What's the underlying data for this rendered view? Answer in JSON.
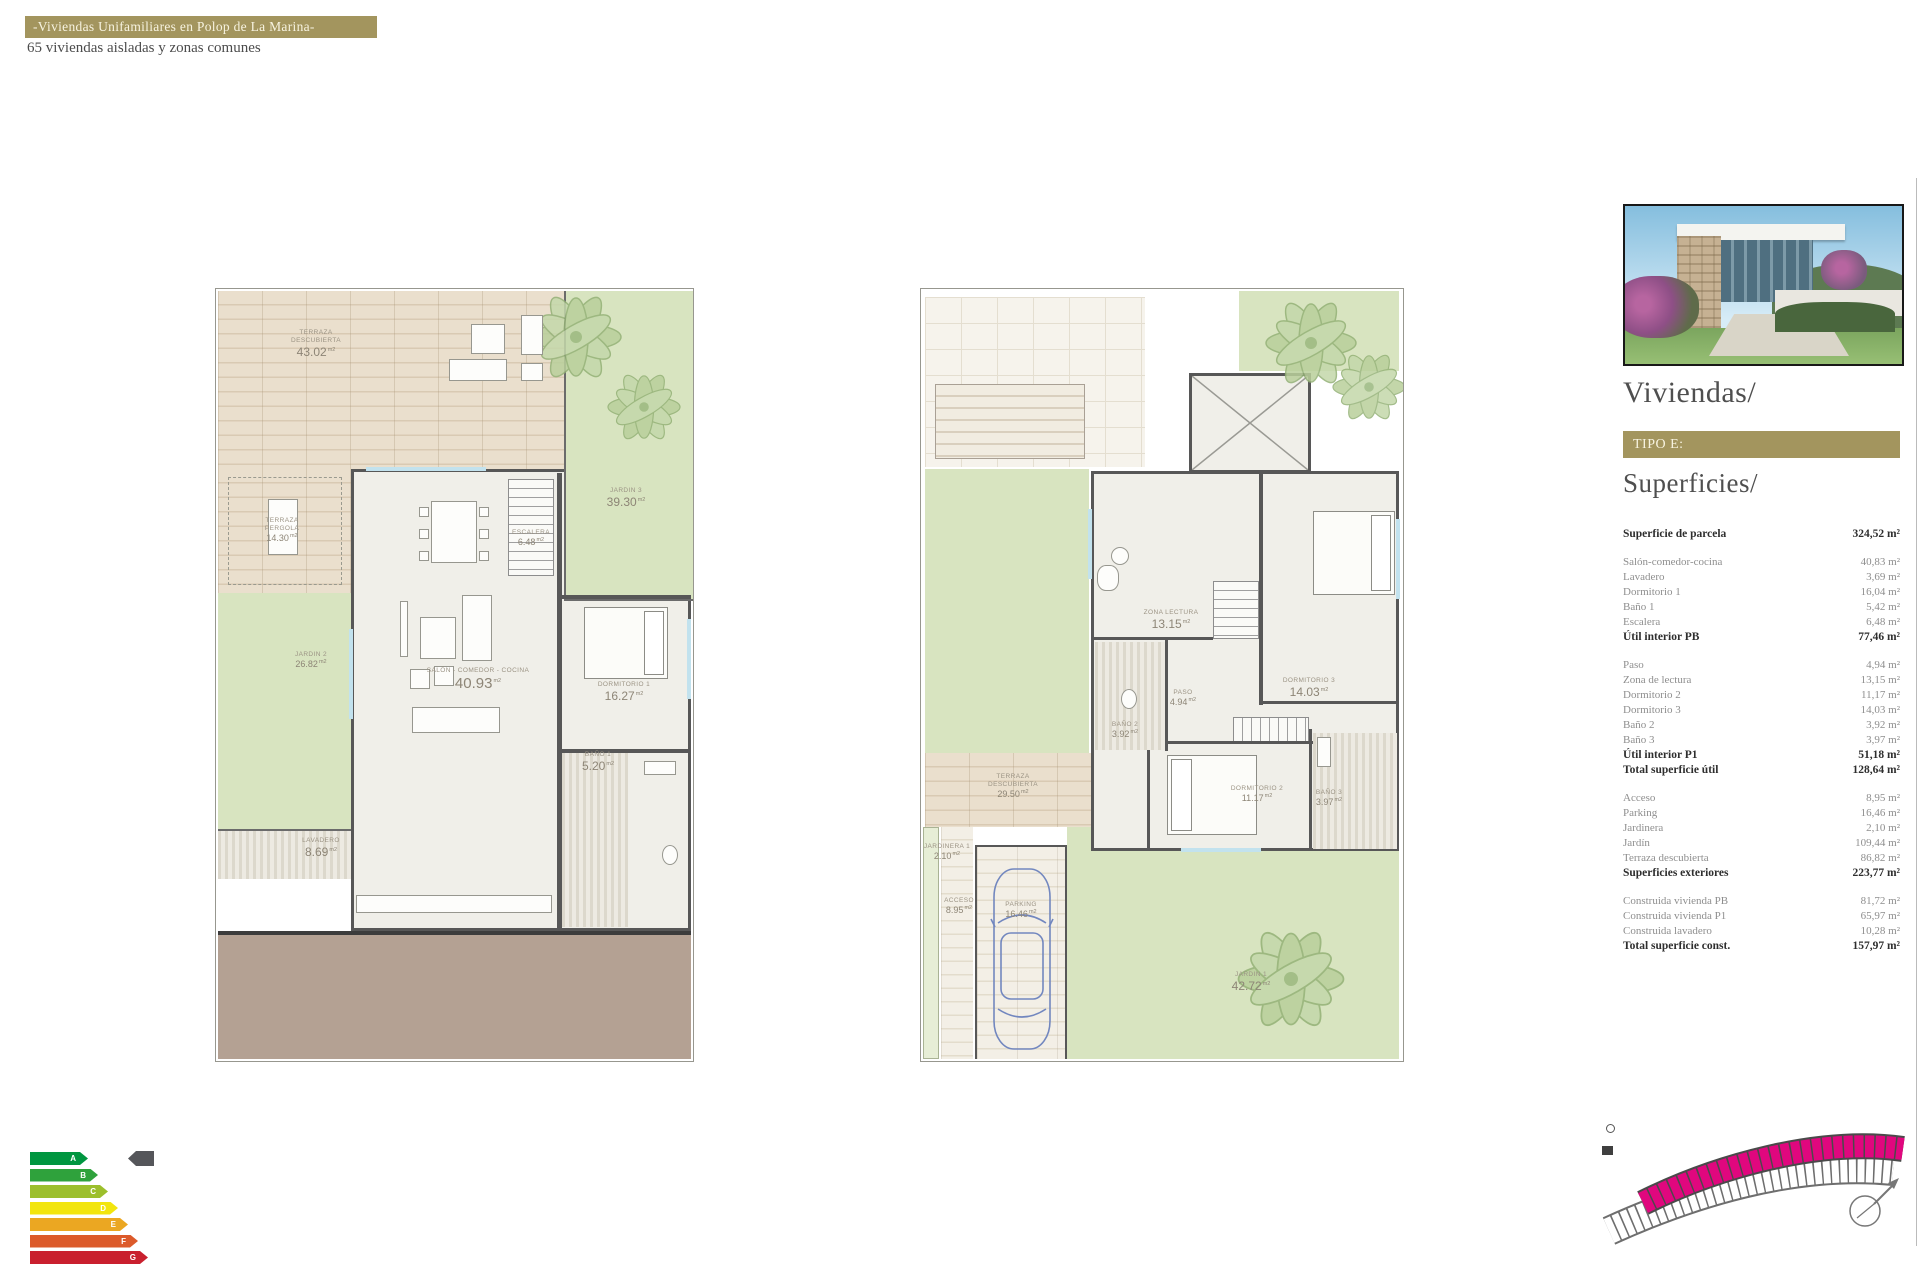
{
  "colors": {
    "gold": "#a3955e",
    "magenta": "#e0077e"
  },
  "header": {
    "title": "-Viviendas Unifamiliares en Polop de La Marina-",
    "subtitle": "65 viviendas aisladas y zonas comunes"
  },
  "units": {
    "plan": "m2"
  },
  "plan_ground": {
    "rooms": {
      "terraza": {
        "label": "TERRAZA DESCUBIERTA",
        "area": "43.02"
      },
      "jardin3": {
        "label": "JARDIN 3",
        "area": "39.30"
      },
      "pergola": {
        "label": "TERRAZA PERGOLA",
        "area": "14.30"
      },
      "escalera": {
        "label": "ESCALERA",
        "area": "6.48"
      },
      "salon": {
        "label": "SALÓN - COMEDOR - COCINA",
        "area": "40.93"
      },
      "dormitorio1": {
        "label": "DORMITORIO 1",
        "area": "16.27"
      },
      "bano1": {
        "label": "BAÑO 1",
        "area": "5.20"
      },
      "lavadero": {
        "label": "LAVADERO",
        "area": "8.69"
      },
      "jardin2": {
        "label": "JARDIN 2",
        "area": "26.82"
      }
    }
  },
  "plan_first": {
    "rooms": {
      "zona": {
        "label": "ZONA LECTURA",
        "area": "13.15"
      },
      "paso": {
        "label": "PASO",
        "area": "4.94"
      },
      "dormitorio3": {
        "label": "DORMITORIO 3",
        "area": "14.03"
      },
      "bano2": {
        "label": "BAÑO 2",
        "area": "3.92"
      },
      "dormitorio2": {
        "label": "DORMITORIO 2",
        "area": "11.17"
      },
      "bano3": {
        "label": "BAÑO 3",
        "area": "3.97"
      },
      "terraza": {
        "label": "TERRAZA DESCUBIERTA",
        "area": "29.50"
      },
      "jardinera": {
        "label": "JARDINERA 1",
        "area": "2.10"
      },
      "acceso": {
        "label": "ACCESO",
        "area": "8.95"
      },
      "parking": {
        "label": "PARKING",
        "area": "16.46"
      },
      "jardin1": {
        "label": "JARDIN 1",
        "area": "42.72"
      }
    }
  },
  "sidebar": {
    "title": "Viviendas/",
    "tipo": "TIPO E:",
    "surfaces_title": "Superficies/",
    "surfaces": {
      "groups": [
        [
          {
            "label": "Superficie de parcela",
            "value": "324,52 m²",
            "bold": true
          }
        ],
        [
          {
            "label": "Salón-comedor-cocina",
            "value": "40,83 m²"
          },
          {
            "label": "Lavadero",
            "value": "3,69 m²"
          },
          {
            "label": "Dormitorio 1",
            "value": "16,04 m²"
          },
          {
            "label": "Baño 1",
            "value": "5,42 m²"
          },
          {
            "label": "Escalera",
            "value": "6,48 m²"
          },
          {
            "label": "Útil interior PB",
            "value": "77,46 m²",
            "bold": true
          }
        ],
        [
          {
            "label": "Paso",
            "value": "4,94 m²"
          },
          {
            "label": "Zona de lectura",
            "value": "13,15 m²"
          },
          {
            "label": "Dormitorio 2",
            "value": "11,17 m²"
          },
          {
            "label": "Dormitorio 3",
            "value": "14,03 m²"
          },
          {
            "label": "Baño 2",
            "value": "3,92 m²"
          },
          {
            "label": "Baño 3",
            "value": "3,97 m²"
          },
          {
            "label": "Útil interior P1",
            "value": "51,18 m²",
            "bold": true
          },
          {
            "label": "Total superficie útil",
            "value": "128,64 m²",
            "bold": true
          }
        ],
        [
          {
            "label": "Acceso",
            "value": "8,95 m²"
          },
          {
            "label": "Parking",
            "value": "16,46 m²"
          },
          {
            "label": "Jardinera",
            "value": "2,10 m²"
          },
          {
            "label": "Jardín",
            "value": "109,44 m²"
          },
          {
            "label": "Terraza descubierta",
            "value": "86,82 m²"
          },
          {
            "label": "Superficies exteriores",
            "value": "223,77 m²",
            "bold": true
          }
        ],
        [
          {
            "label": "Construida vivienda PB",
            "value": "81,72 m²"
          },
          {
            "label": "Construida vivienda P1",
            "value": "65,97 m²"
          },
          {
            "label": "Construida lavadero",
            "value": "10,28 m²"
          },
          {
            "label": "Total superficie const.",
            "value": "157,97 m²",
            "bold": true
          }
        ]
      ]
    }
  },
  "energy": {
    "levels": [
      {
        "letter": "A",
        "color": "#009640"
      },
      {
        "letter": "B",
        "color": "#2fa23c"
      },
      {
        "letter": "C",
        "color": "#9cbf2c"
      },
      {
        "letter": "D",
        "color": "#f2e50e"
      },
      {
        "letter": "E",
        "color": "#eba722"
      },
      {
        "letter": "F",
        "color": "#dc5a2a"
      },
      {
        "letter": "G",
        "color": "#c9202e"
      }
    ]
  }
}
